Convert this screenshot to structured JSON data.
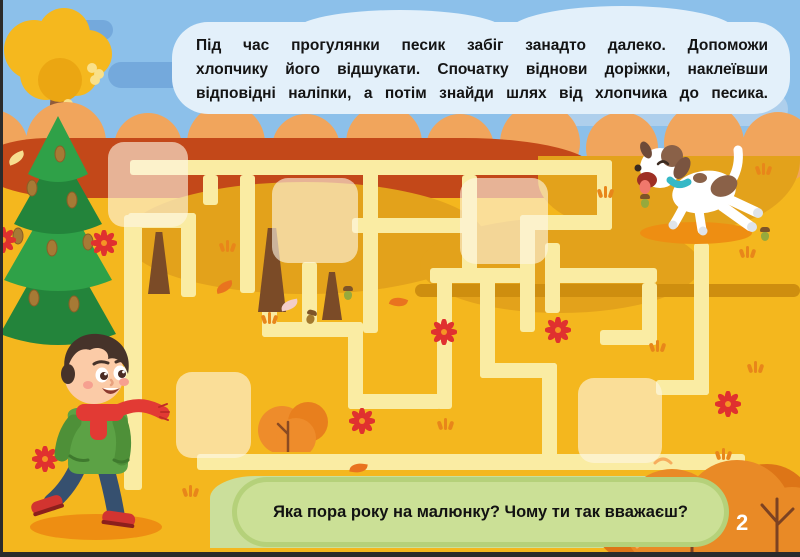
{
  "instruction_bubble": {
    "text": "Під час прогулянки песик забіг занадто далеко. Допоможи хлопчику його відшукати. Спочатку віднови доріжки, наклеївши відповідні наліпки, а потім знайди шлях від хлопчика до песика.",
    "lines": [
      "Під час прогулянки песик забіг занадто далеко. Допоможи",
      "хлопчику його відшукати. Спочатку віднови доріжки, наклеївши",
      "відповідні наліпки, а потім знайди шлях від хлопчика до песика."
    ]
  },
  "question_bubble": {
    "text": "Яка пора року на малюнку? Чому ти так вважаєш?"
  },
  "page_number": "2",
  "palette": {
    "sky": "#8CC0EA",
    "cloud": "#74A9DC",
    "field": "#F4B71E",
    "field_dark": "#E3A21B",
    "hill_red": "#C34819",
    "bump": "#F1A55C",
    "path": "#FAECA3",
    "sticker": "rgba(253,246,227,0.62)",
    "grass": "#CBDF9B",
    "bubble_green": "#CBE096",
    "bubble_blue": "#E3F0FA",
    "flower": "#E0312F",
    "bush": "#E98A26",
    "dog_collar": "#35B8C6",
    "boy_jacket": "#5CA245",
    "boy_scarf": "#E23A34"
  },
  "maze": {
    "path_color": "#FAECA3",
    "paths": [
      [
        130,
        160,
        482,
        15
      ],
      [
        597,
        160,
        15,
        70
      ],
      [
        520,
        215,
        92,
        15
      ],
      [
        520,
        215,
        15,
        117
      ],
      [
        363,
        160,
        15,
        173
      ],
      [
        352,
        218,
        115,
        15
      ],
      [
        462,
        175,
        15,
        108
      ],
      [
        430,
        268,
        92,
        15
      ],
      [
        203,
        175,
        15,
        30
      ],
      [
        240,
        175,
        15,
        118
      ],
      [
        124,
        215,
        18,
        275
      ],
      [
        128,
        213,
        68,
        15
      ],
      [
        181,
        213,
        15,
        84
      ],
      [
        302,
        262,
        15,
        62
      ],
      [
        262,
        290,
        15,
        47
      ],
      [
        262,
        322,
        101,
        15
      ],
      [
        348,
        322,
        15,
        87
      ],
      [
        348,
        394,
        93,
        15
      ],
      [
        437,
        276,
        15,
        133
      ],
      [
        480,
        276,
        15,
        102
      ],
      [
        480,
        363,
        77,
        15
      ],
      [
        542,
        363,
        15,
        106
      ],
      [
        197,
        454,
        548,
        16
      ],
      [
        545,
        243,
        15,
        70
      ],
      [
        545,
        268,
        112,
        15
      ],
      [
        642,
        283,
        15,
        52
      ],
      [
        600,
        330,
        57,
        15
      ],
      [
        694,
        243,
        15,
        152
      ],
      [
        656,
        380,
        53,
        15
      ]
    ],
    "stickers": [
      [
        108,
        142,
        80,
        85
      ],
      [
        272,
        178,
        86,
        85
      ],
      [
        460,
        178,
        88,
        86
      ],
      [
        176,
        372,
        75,
        86
      ],
      [
        578,
        378,
        84,
        85
      ]
    ]
  },
  "decor": {
    "bumps": [
      [
        -8,
        146,
        36
      ],
      [
        66,
        142,
        40
      ],
      [
        148,
        147,
        34
      ],
      [
        226,
        143,
        39
      ],
      [
        306,
        148,
        34
      ],
      [
        384,
        143,
        38
      ],
      [
        460,
        148,
        34
      ],
      [
        540,
        143,
        40
      ],
      [
        622,
        148,
        36
      ],
      [
        704,
        143,
        40
      ],
      [
        778,
        148,
        36
      ]
    ],
    "trunks": [
      [
        148,
        232,
        22,
        62
      ],
      [
        258,
        228,
        28,
        84
      ],
      [
        322,
        272,
        20,
        48
      ]
    ],
    "flowers": [
      [
        3,
        240
      ],
      [
        104,
        243
      ],
      [
        45,
        459
      ],
      [
        294,
        427
      ],
      [
        362,
        421
      ],
      [
        444,
        332
      ],
      [
        558,
        330
      ],
      [
        728,
        404
      ]
    ],
    "tufts": [
      [
        220,
        240
      ],
      [
        598,
        186
      ],
      [
        756,
        163
      ],
      [
        740,
        246
      ],
      [
        748,
        361
      ],
      [
        650,
        340
      ],
      [
        438,
        418
      ],
      [
        183,
        485
      ],
      [
        716,
        448
      ],
      [
        262,
        312
      ]
    ],
    "leaves": [
      [
        216,
        282,
        "#E9731F",
        -15
      ],
      [
        390,
        297,
        "#E9731F",
        20
      ],
      [
        281,
        300,
        "#F3CDC9",
        -10
      ],
      [
        350,
        463,
        "#E9731F",
        10
      ],
      [
        8,
        153,
        "#F7DE8F",
        -20
      ]
    ],
    "acorns": [
      [
        343,
        286,
        "#97A93C",
        0
      ],
      [
        306,
        310,
        "#A3792F",
        15
      ],
      [
        640,
        194,
        "#97A93C",
        0
      ],
      [
        760,
        227,
        "#97A93C",
        0
      ]
    ]
  }
}
